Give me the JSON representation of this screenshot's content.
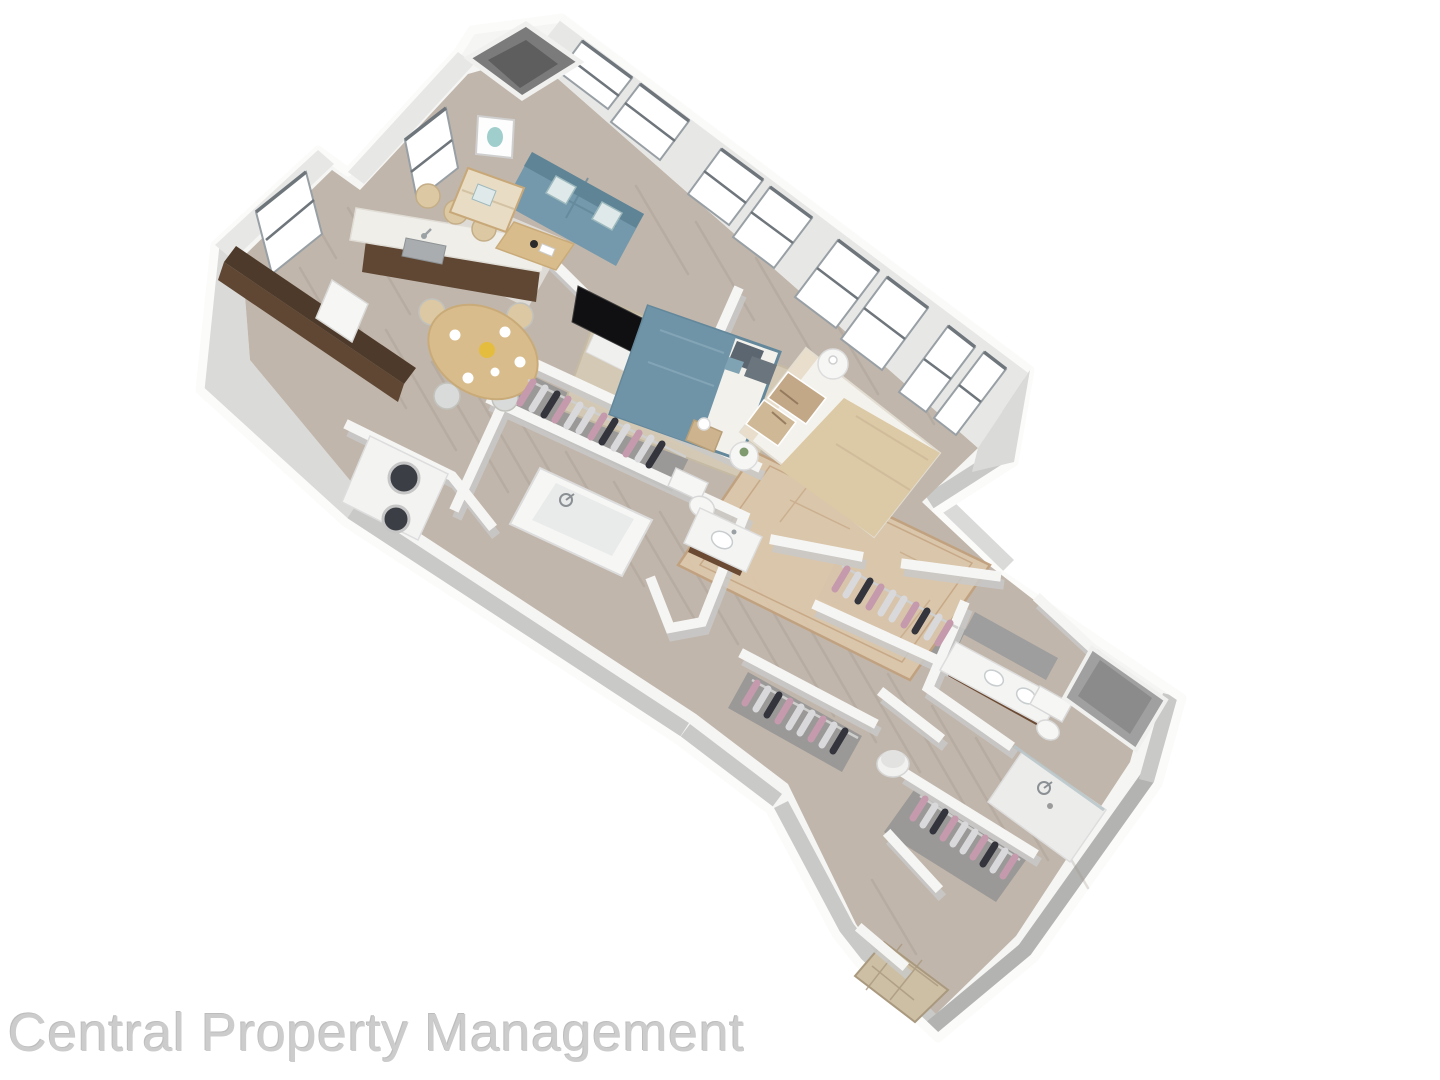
{
  "watermark": {
    "text": "Central Property Management",
    "color": "#cccccc"
  },
  "scene": {
    "type": "3d-dollhouse-floor-plan-rendering",
    "rooms": [
      "open-kitchen-living-dining",
      "bedroom-1",
      "bedroom-2",
      "bathroom-1",
      "bathroom-2",
      "walk-in-closet-1",
      "walk-in-closet-2",
      "entry-closet",
      "hall-closet",
      "laundry-closet",
      "entry-hall"
    ],
    "furniture": [
      "blue-sofa",
      "cream-armchair",
      "coffee-table",
      "wall-art",
      "tv-on-partial-wall",
      "kitchen-island-with-sink",
      "dark-wood-counter-run",
      "refrigerator",
      "round-dining-table",
      "dining-chairs",
      "island-stools",
      "bed-blue-bedding",
      "bed-beige-bedding",
      "nightstands",
      "table-lamps",
      "jute-rug",
      "ornate-rug",
      "entry-rug",
      "living-rug",
      "bathtub",
      "toilet",
      "single-sink-vanity",
      "double-sink-vanity",
      "walk-in-shower-glass",
      "linen-niche",
      "stacked-washer-dryer",
      "hanging-clothes",
      "round-hamper",
      "hvac-shaft",
      "windows"
    ]
  },
  "palette": {
    "background": "#ffffff",
    "wall_top": "#f5f5f4",
    "wall_rim": "#fbfbfa",
    "wall_face": "#c9c9c8",
    "wall_face_light": "#dadad9",
    "wall_face_dark": "#b3b3b2",
    "wall_inner": "#e7e7e6",
    "floor": "#c1b6ab",
    "floor_streak": "#9f9488",
    "glass": "#ffffff",
    "window_frame": "#98a0a5",
    "window_frame_dark": "#6e767c",
    "shaft": "#7b7b7b",
    "shaft_dark": "#5e5e5e",
    "sofa": "#7499ac",
    "sofa_dark": "#5f8496",
    "cushion": "#dfe9ea",
    "armchair": "#e9dcc4",
    "wood_light": "#d9bc8b",
    "wood_mid": "#c8a878",
    "cabinet_dark": "#4e3a2a",
    "cabinet_face": "#5f4733",
    "vanity_wood": "#6b4a33",
    "fixture": "#f6f6f5",
    "fixture_shade": "#e9ebeb",
    "steel": "#a9adb0",
    "tv": "#101012",
    "art_teal": "#8fc6c4",
    "bed1_duvet": "#6f94a8",
    "bed1_frame": "#64889b",
    "pillow_dark": "#5c6670",
    "bed2_duvet": "#dcc9a5",
    "bed2_head": "#e8decb",
    "pillow_tan": "#c3a888",
    "rug_living": "#e1deda",
    "rug_jute": "#d6cbb6",
    "rug_ornate": "#dcc7ab",
    "rug_ornate_line": "#c2a17e",
    "rug_entry": "#cdbfa3",
    "rug_entry_line": "#a9997f",
    "clothes_pink": "#c59aac",
    "clothes_dark": "#33343c",
    "clothes_light": "#d9d9dc",
    "niche": "#a0a0a0",
    "watermark": "#cccccc"
  }
}
